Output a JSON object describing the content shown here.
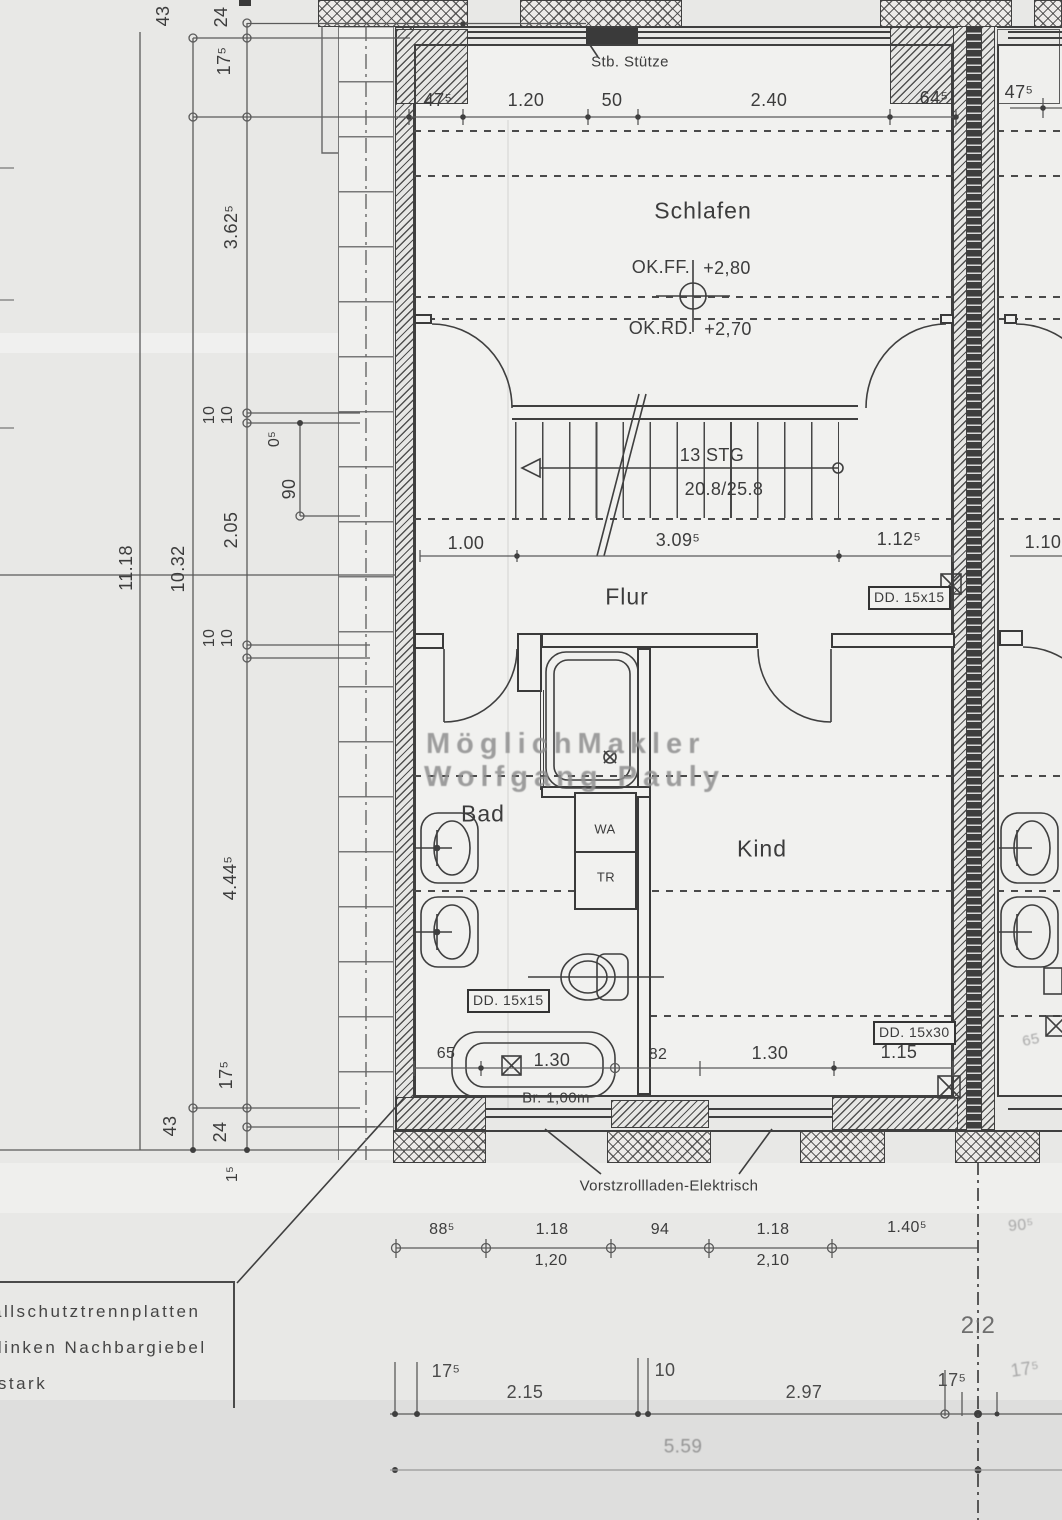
{
  "watermark": {
    "line1": "MöglichMakler",
    "line2": "Wolfgang Pauly"
  },
  "rooms": {
    "schlafen": "Schlafen",
    "flur": "Flur",
    "bad": "Bad",
    "kind": "Kind"
  },
  "annotations": {
    "stb_stuetze": "Stb. Stütze",
    "ok_ff_label": "OK.FF.",
    "ok_ff_value": "+2,80",
    "ok_rd_label": "OK.RD.",
    "ok_rd_value": "+2,70",
    "stairs_count": "13  STG",
    "stairs_ratio": "20.8/25.8",
    "washer": "WA",
    "dryer": "TR",
    "beam_flur": "DD. 15x15",
    "beam_bad": "DD. 15x15",
    "beam_kind": "DD. 15x30",
    "tub_width": "Br.  1,00m",
    "shutters": "Vorstzrollladen-Elektrisch",
    "axis_label": "2:2",
    "neighbor_width": "65"
  },
  "note_box": {
    "line1": "allschutztrennplatten",
    "line2": "m  linken  Nachbargiebel",
    "line3": "m  stark"
  },
  "dims": {
    "top": [
      "47⁵",
      "1.20",
      "50",
      "2.40",
      "64⁵"
    ],
    "top_neighbor": "47⁵",
    "stair_row": [
      "1.00",
      "3.09⁵",
      "1.12⁵"
    ],
    "stair_row_neighbor": "1.10",
    "bad_row": [
      "65",
      "1.30",
      "82",
      "1.30",
      "1.15"
    ],
    "window_row": [
      "88⁵",
      "1.18",
      "94",
      "1.18",
      "1.40⁵"
    ],
    "window_row_sub": [
      "1,20",
      "2,10"
    ],
    "window_row_right": "90⁵",
    "grid_row": [
      "17⁵",
      "2.15",
      "10",
      "2.97",
      "17⁵",
      "17⁵"
    ],
    "total_row": "5.59",
    "left_col": [
      "43",
      "24",
      "17⁵",
      "3.62⁵",
      "10",
      "10",
      "0⁵",
      "90",
      "2.05",
      "10.32",
      "11.18",
      "10",
      "10",
      "4.44⁵",
      "17⁵",
      "43",
      "24",
      "1⁵"
    ]
  }
}
